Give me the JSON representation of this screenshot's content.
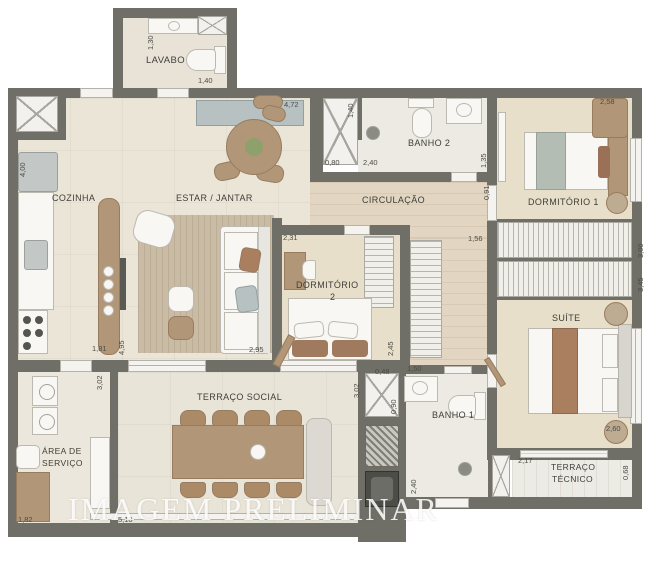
{
  "watermark": "IMAGEM PRELIMINAR",
  "rooms": {
    "lavabo": {
      "label": "LAVABO"
    },
    "cozinha": {
      "label": "COZINHA"
    },
    "estar_jantar": {
      "label": "ESTAR / JANTAR"
    },
    "circulacao": {
      "label": "CIRCULAÇÃO"
    },
    "banho2": {
      "label": "BANHO 2"
    },
    "dormitorio1": {
      "label": "DORMITÓRIO 1"
    },
    "dormitorio2": {
      "label_line1": "DORMITÓRIO",
      "label_line2": "2"
    },
    "suite": {
      "label": "SUÍTE"
    },
    "terraco_social": {
      "label": "TERRAÇO SOCIAL"
    },
    "area_servico": {
      "label_line1": "ÁREA DE",
      "label_line2": "SERVIÇO"
    },
    "banho1": {
      "label": "BANHO 1"
    },
    "terraco_tecnico": {
      "label_line1": "TERRAÇO",
      "label_line2": "TÉCNICO"
    }
  },
  "dimensions": [
    {
      "text": "1,30",
      "x": 146,
      "y": 50,
      "rot": true
    },
    {
      "text": "1,40",
      "x": 198,
      "y": 76,
      "rot": false
    },
    {
      "text": "4,72",
      "x": 284,
      "y": 100,
      "rot": false
    },
    {
      "text": "1,40",
      "x": 346,
      "y": 118,
      "rot": true
    },
    {
      "text": "0,80",
      "x": 325,
      "y": 158,
      "rot": false
    },
    {
      "text": "2,40",
      "x": 363,
      "y": 158,
      "rot": false
    },
    {
      "text": "1,35",
      "x": 479,
      "y": 168,
      "rot": true
    },
    {
      "text": "0,91",
      "x": 482,
      "y": 200,
      "rot": true
    },
    {
      "text": "2,58",
      "x": 600,
      "y": 97,
      "rot": false
    },
    {
      "text": "3,00",
      "x": 636,
      "y": 258,
      "rot": true
    },
    {
      "text": "3,45",
      "x": 636,
      "y": 292,
      "rot": true
    },
    {
      "text": "2,31",
      "x": 283,
      "y": 233,
      "rot": false
    },
    {
      "text": "2,45",
      "x": 386,
      "y": 356,
      "rot": true
    },
    {
      "text": "1,56",
      "x": 468,
      "y": 234,
      "rot": false
    },
    {
      "text": "4,00",
      "x": 18,
      "y": 177,
      "rot": true
    },
    {
      "text": "1,81",
      "x": 92,
      "y": 344,
      "rot": false
    },
    {
      "text": "4,95",
      "x": 117,
      "y": 355,
      "rot": true
    },
    {
      "text": "3,02",
      "x": 95,
      "y": 390,
      "rot": true
    },
    {
      "text": "3,02",
      "x": 352,
      "y": 398,
      "rot": true
    },
    {
      "text": "0,48",
      "x": 375,
      "y": 367,
      "rot": false
    },
    {
      "text": "0,90",
      "x": 389,
      "y": 414,
      "rot": true
    },
    {
      "text": "1,50",
      "x": 407,
      "y": 364,
      "rot": false
    },
    {
      "text": "2,40",
      "x": 409,
      "y": 494,
      "rot": true
    },
    {
      "text": "2,95",
      "x": 249,
      "y": 345,
      "rot": false
    },
    {
      "text": "1,82",
      "x": 18,
      "y": 515,
      "rot": false
    },
    {
      "text": "5,18",
      "x": 118,
      "y": 515,
      "rot": false
    },
    {
      "text": "2,17",
      "x": 518,
      "y": 456,
      "rot": false
    },
    {
      "text": "0,68",
      "x": 621,
      "y": 480,
      "rot": true
    },
    {
      "text": "2,60",
      "x": 606,
      "y": 424,
      "rot": false
    }
  ],
  "colors": {
    "wall": "#6f6f67",
    "floor_living": "#ebe5d8",
    "floor_bedroom": "#e8dfca",
    "floor_bath": "#eceae3",
    "floor_terrace": "#e9e4d8",
    "wood": "#b29678",
    "cabinet_blue": "#b7c1c2",
    "watermark_white": "#ffffff"
  }
}
